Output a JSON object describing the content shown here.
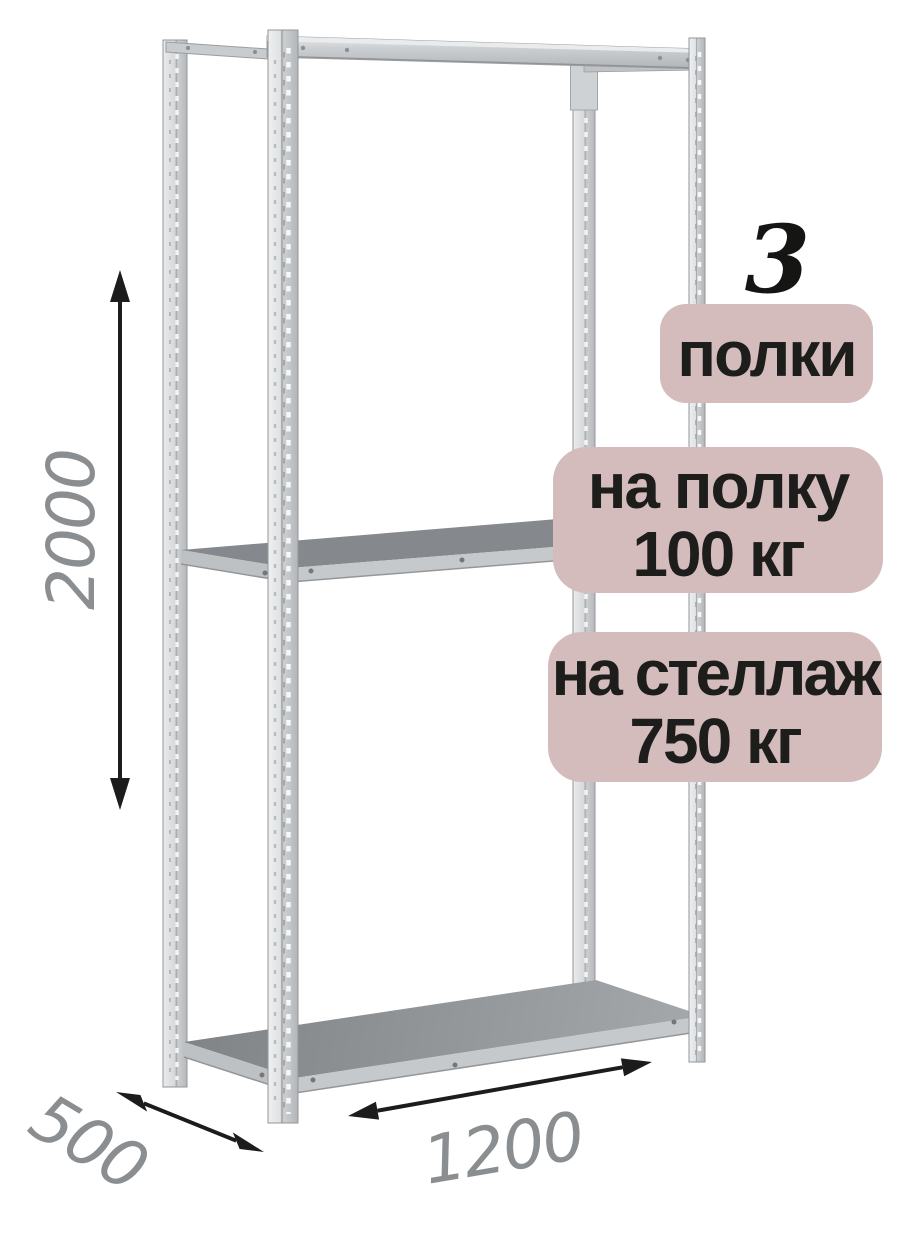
{
  "badges": {
    "bg_color": "#d5bcbc",
    "text_color": "#1d1d1b",
    "shelf_count": {
      "number": "3",
      "label": "полки"
    },
    "shelf_load": {
      "line1": "на полку",
      "line2": "100 кг"
    },
    "rack_load": {
      "line1": "на стеллаж",
      "line2": "750 кг"
    }
  },
  "dimensions": {
    "height_mm": "2000",
    "depth_mm": "500",
    "width_mm": "1200",
    "text_color": "#8b8e90",
    "arrow_color": "#1c1c1c"
  },
  "illustration": {
    "subject": "metal-shelving-rack",
    "shelf_count": 3,
    "metal_light": "#eef0f1",
    "metal_mid": "#c0c3c5",
    "metal_edge": "#93969a",
    "deck_color": "#85888c",
    "deck_front_band": "#c6c9cb"
  }
}
